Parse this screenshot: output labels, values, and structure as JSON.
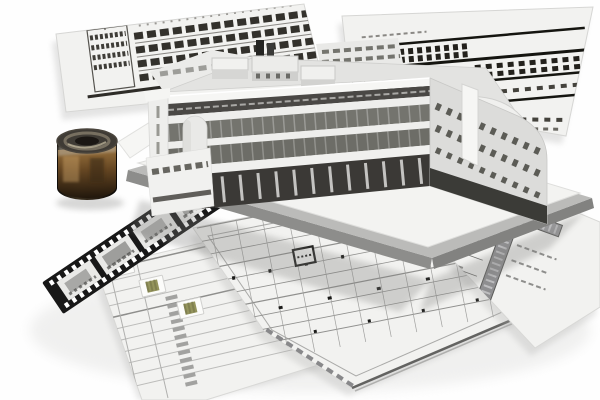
{
  "scene": {
    "type": "architectural-visualization",
    "description": "White 3D building massing model standing on a gray base slab, surrounded by tilted blueprint sheets (two elevations, a floor plan, a wall-section detail, a schedule sheet with stamp cards), a 35mm film strip with building photos, and a small cylinder wrapped in a sepia interior photograph.",
    "objects": [
      {
        "id": "blueprint-elevation-left",
        "label": "Elevation blueprint sheet (top left)"
      },
      {
        "id": "blueprint-elevation-right",
        "label": "Elevation blueprint sheet (top right)"
      },
      {
        "id": "building-model",
        "label": "White 3D massing model"
      },
      {
        "id": "ground-slab",
        "label": "Gray presentation base slab"
      },
      {
        "id": "floor-plan-sheet",
        "label": "Floor plan drawing sheet (bottom center)"
      },
      {
        "id": "detail-section-sheet",
        "label": "Wall-section detail sheet (bottom right)"
      },
      {
        "id": "schedule-sheet",
        "label": "Schedule sheet with stamp cards (bottom left)",
        "stamp_count": 3
      },
      {
        "id": "film-strip",
        "label": "Film strip with building photo frames",
        "frames": 5
      },
      {
        "id": "texture-cylinder",
        "label": "Cylinder wrapped with sepia interior photo"
      }
    ]
  },
  "palette": {
    "background": "#fefefe",
    "paper": "#f2f2f0",
    "paper_edge": "#c9c9c7",
    "drawing_line": "#2f2d29",
    "slab": "#bbbbb9",
    "slab_edge": "#8d8d8b",
    "board": "#f3f3f1",
    "building": "#f6f6f4",
    "building_shade": "#dcdcda",
    "band_dark": "#4a4845",
    "glass": "#74746e",
    "base_dark": "#3b3936",
    "roof": "#e3e3e1",
    "film": "#181818",
    "frame": "#e9e9e7",
    "cylinder": "#1b150e",
    "sepia": "#8a6434",
    "sepia_light": "#c59a60",
    "stamp": "#94945c",
    "shadow": "#8f8f8d"
  }
}
